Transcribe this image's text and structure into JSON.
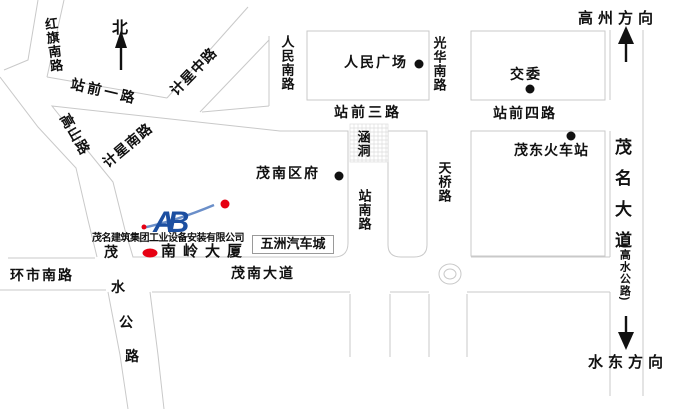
{
  "compass": {
    "north_label": "北"
  },
  "directions": {
    "top": "高州方向",
    "bottom": "水东方向"
  },
  "roads": {
    "hongqi_south": "红旗南路",
    "zhanqian_1": "站前一路",
    "jixing_middle": "计星中路",
    "jixing_south": "计星南路",
    "gaoshan": "高山路",
    "renmin_south": "人民南路",
    "guanghua_south": "光华南路",
    "zhanqian_3": "站前三路",
    "zhanqian_4": "站前四路",
    "tianqiao": "天桥路",
    "zhannan": "站南路",
    "culvert": "涵洞",
    "huanshi_south": "环市南路",
    "maonan_avenue": "茂南大道",
    "maoming_avenue": "茂名大道",
    "maoming_avenue_alt": "(高水公路)",
    "maoshui_chars": [
      "茂",
      "水",
      "公",
      "路"
    ]
  },
  "places": {
    "renmin_square": "人民广场",
    "jiaowei": "交委",
    "maodong_station": "茂东火车站",
    "maonan_gov": "茂南区府",
    "wuzhou_auto_city": "五洲汽车城",
    "nanling_building": "南岭大厦"
  },
  "company": {
    "name": "茂名建筑集团工业设备安装有限公司",
    "monogram": "AB"
  },
  "colors": {
    "road_line": "#c9c9c9",
    "ink": "#111111",
    "red": "#e60012",
    "blue": "#1c4fa1",
    "swoosh": "#6b8fc9"
  }
}
